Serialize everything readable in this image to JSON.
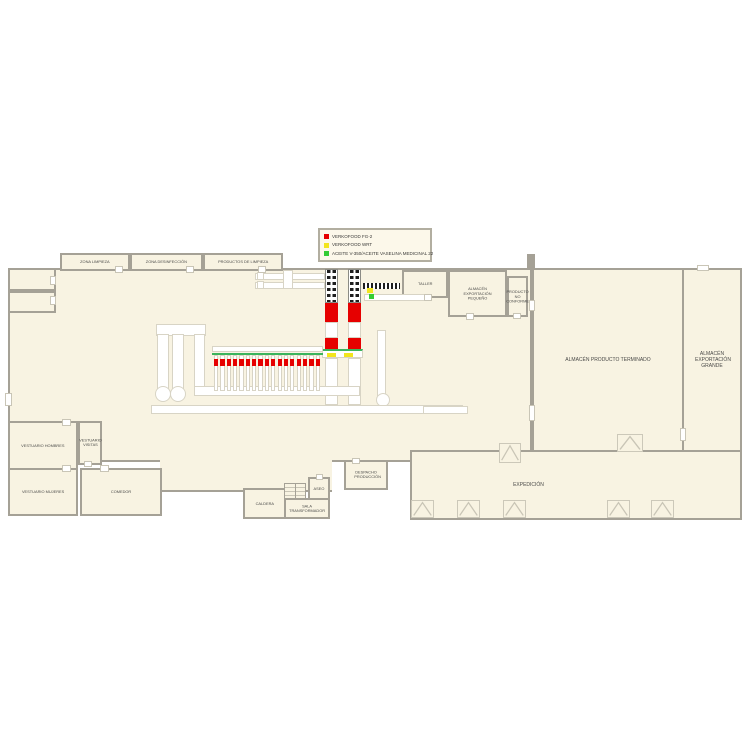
{
  "legend": {
    "items": [
      {
        "swatch": "#e60000",
        "label": "VERKOFOOD FG-2"
      },
      {
        "swatch": "#f2e51e",
        "label": "VERKOFOOD WRT"
      },
      {
        "swatch": "#33cc33",
        "label": "ACEITE V-350/ACEITE VASELINA MEDICINAL 22"
      }
    ]
  },
  "rooms": {
    "zona_limpieza": {
      "label": "ZONA LIMPIEZA"
    },
    "zona_desinfeccion": {
      "label": "ZONA DESINFECCIÓN"
    },
    "productos_limpieza": {
      "label": "PRODUCTOS DE LIMPIEZA"
    },
    "taller": {
      "label": "TALLER"
    },
    "almacen_exportacion_pequeno": {
      "label": "ALMACÉN EXPORTACIÓN PEQUEÑO"
    },
    "producto_no_conforme": {
      "label": "PRODUCTO NO CONFORME"
    },
    "almacen_producto_terminado": {
      "label": "ALMACÉN PRODUCTO TERMINADO"
    },
    "almacen_exportacion_grande": {
      "label": "ALMACÉN EXPORTACIÓN GRANDE"
    },
    "expedicion": {
      "label": "EXPEDICIÓN"
    },
    "despacho_produccion": {
      "label": "DESPACHO PRODUCCIÓN"
    },
    "aseo": {
      "label": "ASEO"
    },
    "sala_transformador": {
      "label": "SALA TRANSFORMADOR"
    },
    "caldera": {
      "label": "CALDERA"
    },
    "vestuario_hombres": {
      "label": "VESTUARIO HOMBRES"
    },
    "vestuario_visitas": {
      "label": "VESTUARIO VISITAS"
    },
    "vestuario_mujeres": {
      "label": "VESTUARIO MUJERES"
    },
    "comedor": {
      "label": "COMEDOR"
    }
  },
  "colors": {
    "floor": "#f8f3e2",
    "wall": "#a5a196",
    "machine_red": "#e60000",
    "machine_yellow": "#f2e51e",
    "machine_green": "#33cc33",
    "line_green": "#3bb45c"
  },
  "machinery": {
    "filler_columns": 17
  }
}
